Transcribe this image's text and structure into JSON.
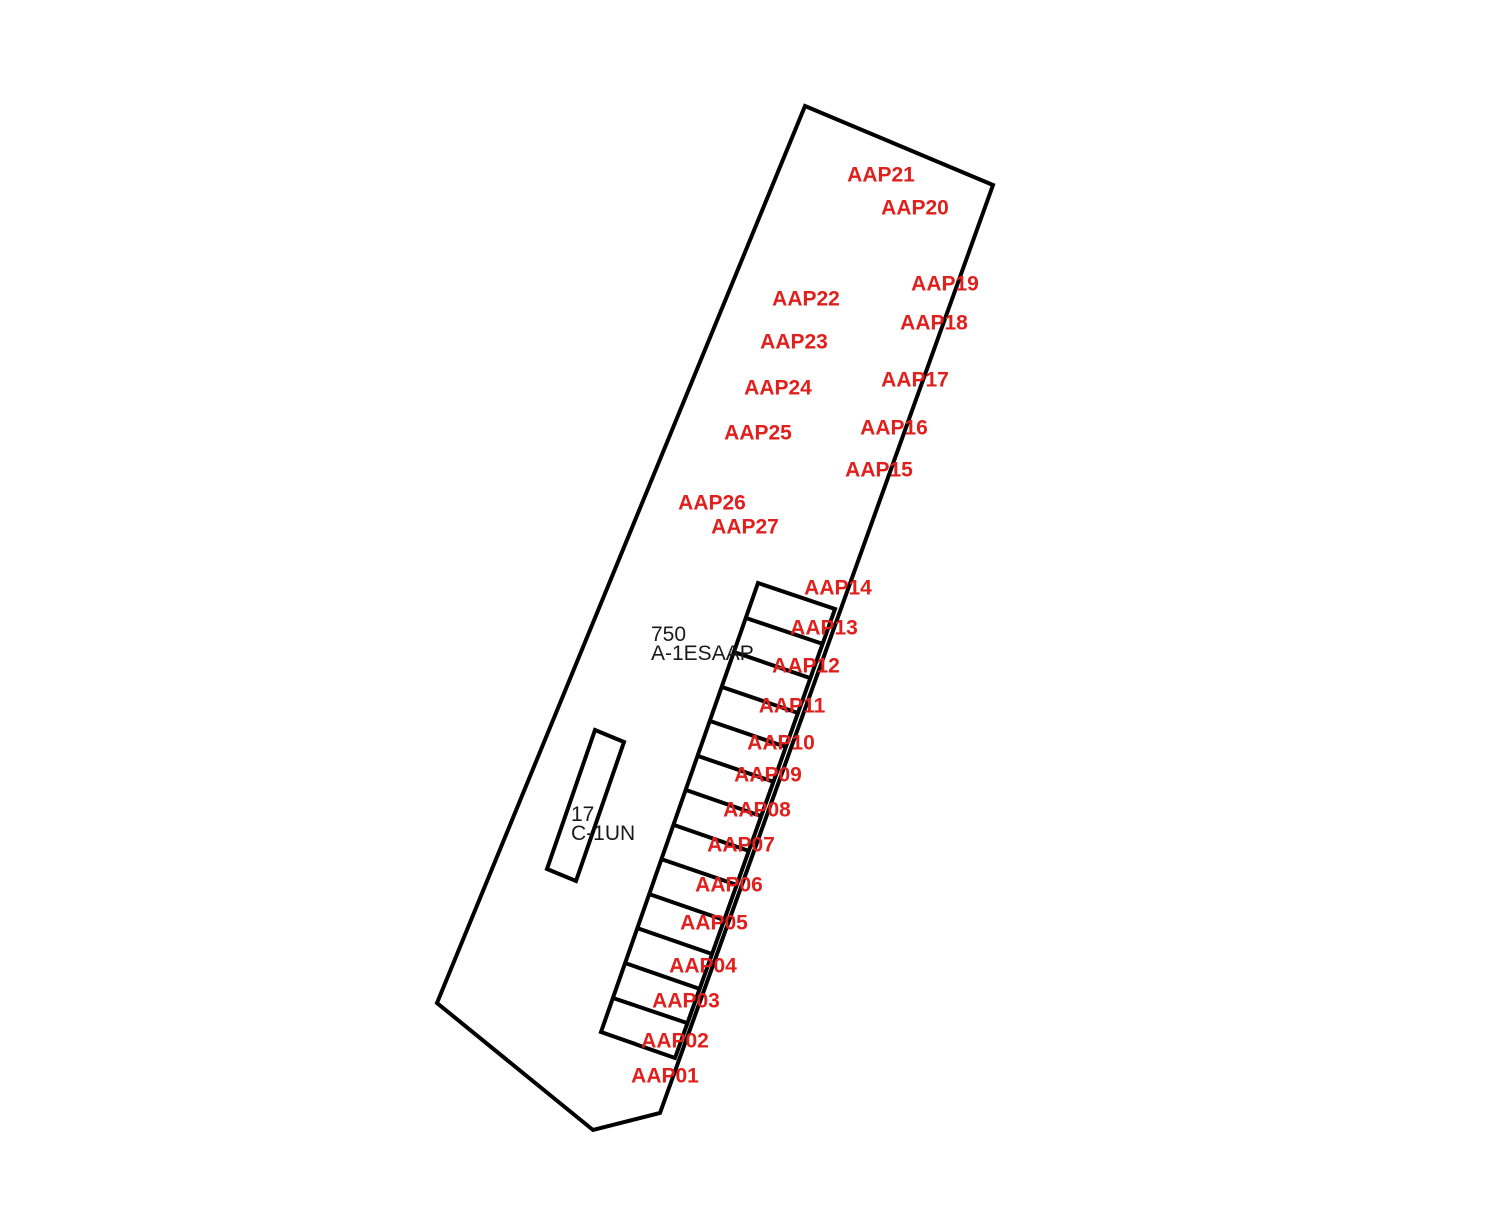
{
  "colors": {
    "background": "#ffffff",
    "outline": "#000000",
    "stall_label": "#df201c",
    "parcel_label": "#1a1a1a"
  },
  "parcels": [
    {
      "number": "750",
      "code": "A-1ESAAP"
    },
    {
      "number": "17",
      "code": "C-1UN"
    }
  ],
  "stall_labels": [
    "AAP01",
    "AAP02",
    "AAP03",
    "AAP04",
    "AAP05",
    "AAP06",
    "AAP07",
    "AAP08",
    "AAP09",
    "AAP10",
    "AAP11",
    "AAP12",
    "AAP13",
    "AAP14",
    "AAP15",
    "AAP16",
    "AAP17",
    "AAP18",
    "AAP19",
    "AAP20",
    "AAP21",
    "AAP22",
    "AAP23",
    "AAP24",
    "AAP25",
    "AAP26",
    "AAP27"
  ]
}
